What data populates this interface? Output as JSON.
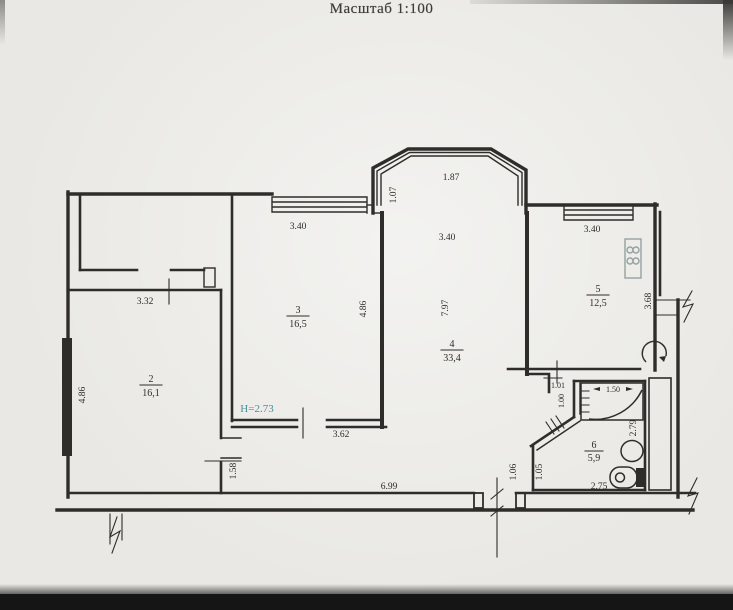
{
  "title": "Масштаб 1:100",
  "rooms": {
    "r2": {
      "number": "2",
      "area": "16,1"
    },
    "r3": {
      "number": "3",
      "area": "16,5"
    },
    "r4": {
      "number": "4",
      "area": "33,4"
    },
    "r5": {
      "number": "5",
      "area": "12,5"
    },
    "r6": {
      "number": "6",
      "area": "5,9"
    }
  },
  "dims": {
    "bay_width": "1.87",
    "bay_side": "1.07",
    "room3_window": "3.40",
    "room4_width": "3.40",
    "room5_window": "3.40",
    "hall_width": "3.32",
    "room2_side": "4.86",
    "room3_side": "4.86",
    "room4_depth": "7.97",
    "room5_side": "3.68",
    "corridor_top": "3.62",
    "room2_door": "1.58",
    "corridor_len": "6.99",
    "entry_left": "1.06",
    "entry_right": "1.05",
    "bath_width": "2.75",
    "bath_side": "2.79",
    "tub_len": "1.50",
    "wc_door": "1.01",
    "wc_niche": "1.00",
    "ceiling_height": "Н=2.73"
  },
  "colors": {
    "ink": "#2f2d2a",
    "paper": "#e9e8e4",
    "note": "#4a8f9c",
    "stove": "#93a2a2"
  }
}
